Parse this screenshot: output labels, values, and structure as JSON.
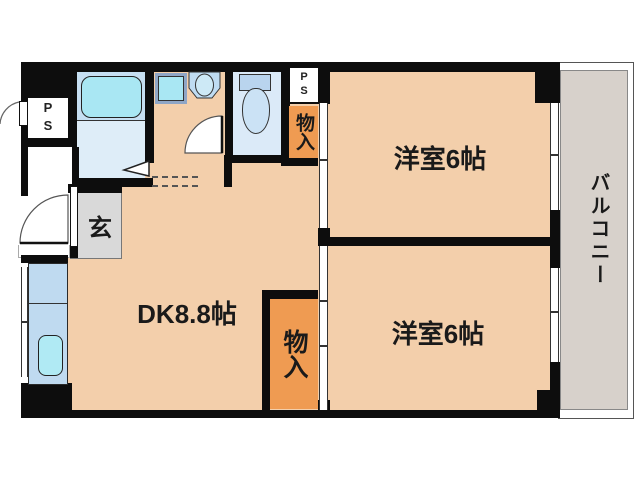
{
  "title": "apartment-floor-plan",
  "labels": {
    "dk": "DK8.8帖",
    "room1": "洋室6帖",
    "room2": "洋室6帖",
    "balcony": "バルコニー",
    "entrance": "玄",
    "closet_upper": "物入",
    "closet_lower": "物入",
    "ps_left": "PS",
    "ps_right": "PS"
  },
  "rooms": [
    {
      "name": "DK (dining-kitchen)",
      "size": "8.8帖"
    },
    {
      "name": "洋室 (western room, upper)",
      "size": "6帖"
    },
    {
      "name": "洋室 (western room, lower)",
      "size": "6帖"
    },
    {
      "name": "バルコニー (balcony)",
      "size": ""
    },
    {
      "name": "玄関 (entrance)",
      "size": ""
    }
  ],
  "fixtures": [
    "bathtub",
    "washing-machine-pan",
    "vanity-sink",
    "toilet",
    "kitchen-counter",
    "kitchen-sink",
    "closet-upper",
    "closet-lower",
    "pipe-space-left",
    "pipe-space-right"
  ],
  "colors": {
    "wall": "#0d0d0d",
    "floor": "#F3CFAB",
    "balcony_floor": "#D7D1CB",
    "entrance_floor": "#D9D9D9",
    "closet_orange": "#EF9B52",
    "bath_upper": "#C6DFF2",
    "bath_lower": "#DEEDF8",
    "toilet_room": "#DBEAF8",
    "fixture_cyan": "#A9E7F3",
    "counter_blue": "#BFDAF0",
    "tank_blue": "#B9D4EE",
    "bowl_blue": "#CBE2F5"
  }
}
